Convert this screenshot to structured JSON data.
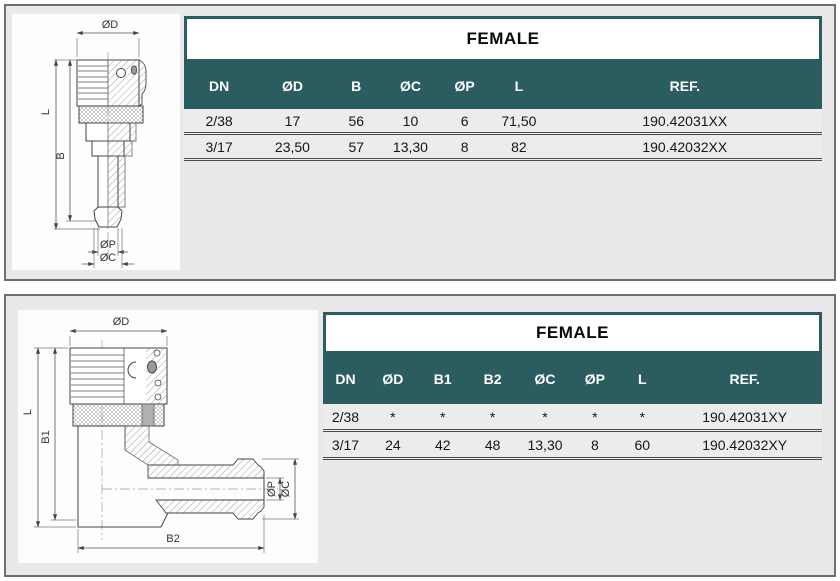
{
  "colors": {
    "teal_header": "#2b5c60",
    "panel_bg": "#e9e9e9",
    "panel_border": "#6f6f6f",
    "row_bg": "#ececec",
    "row_separator": "#4d4d4d"
  },
  "panels": [
    {
      "drawing": {
        "type": "straight female coupling, half-section technical drawing",
        "dim_d": "ØD",
        "dim_l": "L",
        "dim_b": "B",
        "dim_p": "ØP",
        "dim_c": "ØC"
      },
      "table": {
        "title": "FEMALE",
        "headers": [
          "DN",
          "ØD",
          "B",
          "ØC",
          "ØP",
          "L",
          "REF."
        ],
        "rows": [
          [
            "2/38",
            "17",
            "56",
            "10",
            "6",
            "71,50",
            "190.42031XX"
          ],
          [
            "3/17",
            "23,50",
            "57",
            "13,30",
            "8",
            "82",
            "190.42032XX"
          ]
        ]
      }
    },
    {
      "drawing": {
        "type": "90-degree elbow female coupling, half-section technical drawing",
        "dim_d": "ØD",
        "dim_l": "L",
        "dim_b1": "B1",
        "dim_b2": "B2",
        "dim_p": "ØP",
        "dim_c": "ØC"
      },
      "table": {
        "title": "FEMALE",
        "headers": [
          "DN",
          "ØD",
          "B1",
          "B2",
          "ØC",
          "ØP",
          "L",
          "REF."
        ],
        "rows": [
          [
            "2/38",
            "*",
            "*",
            "*",
            "*",
            "*",
            "*",
            "190.42031XY"
          ],
          [
            "3/17",
            "24",
            "42",
            "48",
            "13,30",
            "8",
            "60",
            "190.42032XY"
          ]
        ]
      }
    }
  ]
}
